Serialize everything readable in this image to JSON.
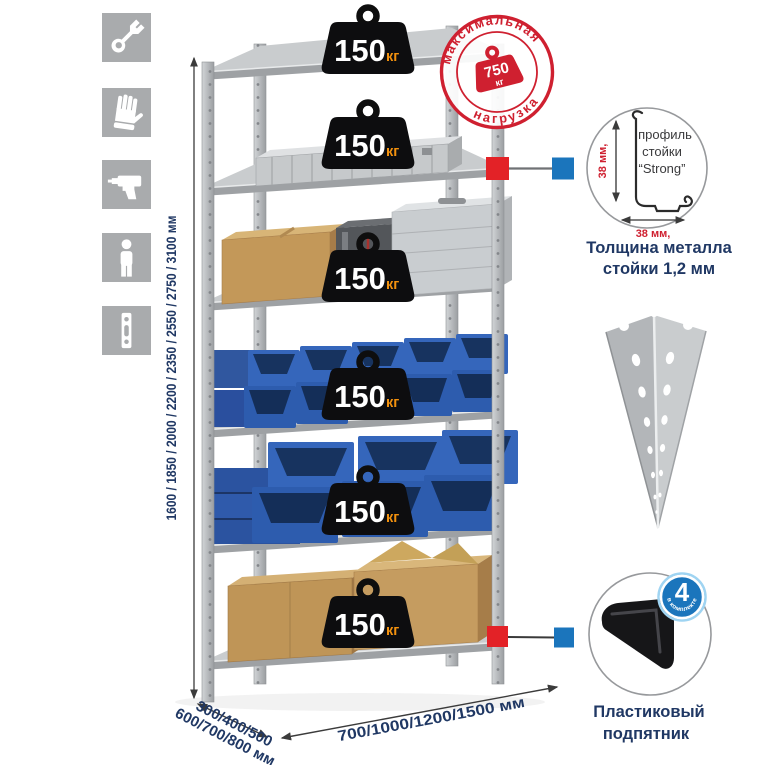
{
  "sidebar": {
    "icons": [
      {
        "name": "wrench-icon"
      },
      {
        "name": "work-gloves-icon"
      },
      {
        "name": "drill-icon"
      },
      {
        "name": "person-icon"
      },
      {
        "name": "perforated-post-icon"
      }
    ]
  },
  "rack": {
    "shelf_count": 6,
    "shelf_load_value": "150",
    "shelf_load_unit": "кг"
  },
  "stamp": {
    "arc_top": "максимальная",
    "arc_bottom": "нагрузка",
    "value": "750",
    "unit": "кг"
  },
  "height_dimension": {
    "label": "1600 / 1850 / 2000 / 2200 / 2350 / 2550 / 2750 / 3100 мм"
  },
  "depth_dimension": {
    "line1": "300/400/500",
    "line2": "600/700/800 мм"
  },
  "width_dimension": {
    "label": "700/1000/1200/1500 мм"
  },
  "profile_callout": {
    "line1": "профиль",
    "line2": "стойки",
    "line3": "“Strong”",
    "vertical_dim": "38 мм,",
    "horizontal_dim": "38 мм,",
    "caption1": "Толщина металла",
    "caption2": "стойки 1,2 мм"
  },
  "foot_callout": {
    "badge_count": "4",
    "badge_arc": "в комплекте",
    "caption1": "Пластиковый",
    "caption2": "подпятник"
  },
  "colors": {
    "stamp_red": "#cf2030",
    "connector_red": "#e32227",
    "connector_blue": "#1b75bc",
    "navy_text": "#203864",
    "weight_black": "#0d0d0f",
    "unit_orange": "#f2910f",
    "bin_blue": "#2d5cae",
    "icon_gray": "#a9abad"
  }
}
